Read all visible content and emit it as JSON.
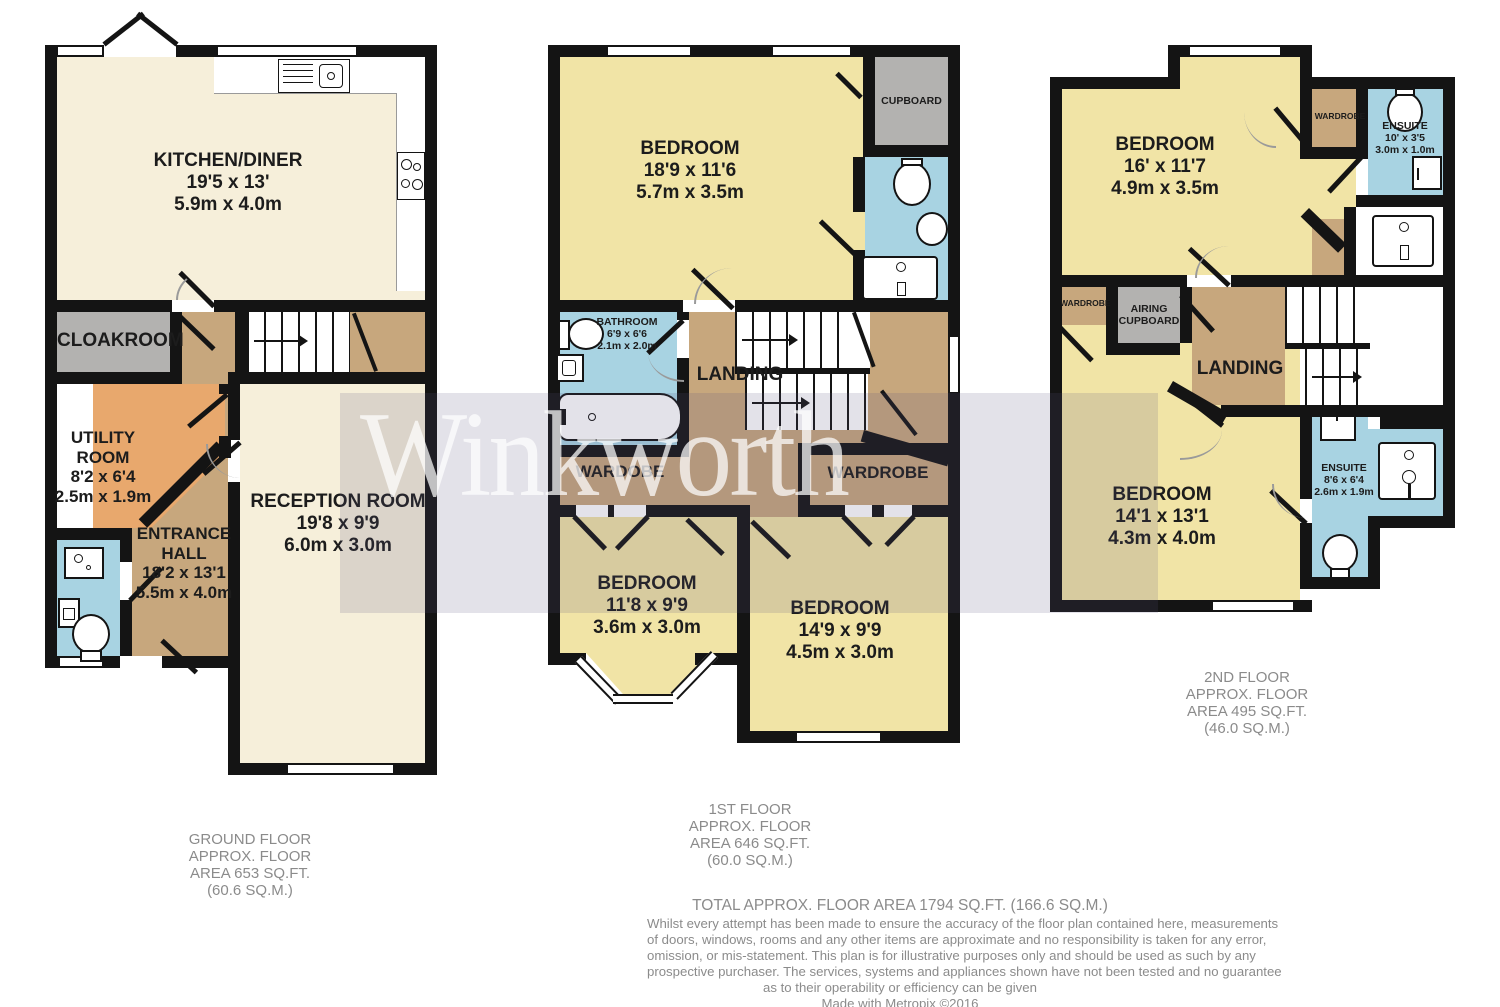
{
  "watermark": {
    "text": "Winkworth"
  },
  "colors": {
    "wall": "#141414",
    "cream": "#F6EFDA",
    "yellow": "#F1E4A6",
    "tan": "#C7A77D",
    "orange": "#E8A86D",
    "blue": "#A8D3E2",
    "grey_room": "#B3B2B0",
    "label_grey": "#8b8b8b",
    "watermark_overlay": "rgba(88,84,126,0.17)"
  },
  "floors": {
    "ground": {
      "rooms": {
        "kitchen": {
          "name": "KITCHEN/DINER",
          "imperial": "19'5 x 13'",
          "metric": "5.9m x 4.0m"
        },
        "cloakroom": {
          "name": "CLOAKROOM"
        },
        "utility": {
          "lines": [
            "UTILITY",
            "ROOM",
            "8'2 x 6'4",
            "2.5m x 1.9m"
          ]
        },
        "entrance": {
          "lines": [
            "ENTRANCE",
            "HALL",
            "18'2 x 13'1",
            "5.5m x 4.0m"
          ]
        },
        "reception": {
          "name": "RECEPTION ROOM",
          "imperial": "19'8 x 9'9",
          "metric": "6.0m x 3.0m"
        }
      },
      "fixtures": [
        "kitchen-sink",
        "hob",
        "washbasin",
        "appliance",
        "toilet"
      ],
      "label": [
        "GROUND FLOOR",
        "APPROX. FLOOR",
        "AREA 653 SQ.FT.",
        "(60.6 SQ.M.)"
      ]
    },
    "first": {
      "rooms": {
        "bedroom1": {
          "name": "BEDROOM",
          "imperial": "18'9 x 11'6",
          "metric": "5.7m x 3.5m"
        },
        "cupboard": {
          "name": "CUPBOARD"
        },
        "bathroom": {
          "name": "BATHROOM",
          "imperial": "6'9 x 6'6",
          "metric": "2.1m x 2.0m"
        },
        "landing": {
          "name": "LANDING"
        },
        "wardrobe_left": {
          "name": "WARDOBE"
        },
        "wardrobe_right": {
          "name": "WARDROBE"
        },
        "bedroom2": {
          "name": "BEDROOM",
          "imperial": "11'8 x 9'9",
          "metric": "3.6m x 3.0m"
        },
        "bedroom3": {
          "name": "BEDROOM",
          "imperial": "14'9 x 9'9",
          "metric": "4.5m x 3.0m"
        }
      },
      "fixtures": [
        "toilet",
        "washbasin",
        "vanity-sink",
        "bath",
        "toilet",
        "washbasin"
      ],
      "label": [
        "1ST FLOOR",
        "APPROX. FLOOR",
        "AREA 646 SQ.FT.",
        "(60.0 SQ.M.)"
      ]
    },
    "second": {
      "rooms": {
        "bedroom1": {
          "name": "BEDROOM",
          "imperial": "16' x 11'7",
          "metric": "4.9m x 3.5m"
        },
        "wardrobe_top": {
          "name": "WARDROBE"
        },
        "ensuite_top": {
          "name": "ENSUITE",
          "imperial": "10' x 3'5",
          "metric": "3.0m x 1.0m"
        },
        "wardrobe_left": {
          "name": "WARDROBE"
        },
        "airing": {
          "lines": [
            "AIRING",
            "CUPBOARD"
          ]
        },
        "landing": {
          "name": "LANDING"
        },
        "bedroom2": {
          "name": "BEDROOM",
          "imperial": "14'1 x 13'1",
          "metric": "4.3m x 4.0m"
        },
        "ensuite_bottom": {
          "name": "ENSUITE",
          "imperial": "8'6 x 6'4",
          "metric": "2.6m x 1.9m"
        }
      },
      "fixtures": [
        "toilet",
        "shower",
        "vanity-sink",
        "washbasin",
        "vanity-sink",
        "toilet"
      ],
      "label": [
        "2ND FLOOR",
        "APPROX. FLOOR",
        "AREA 495 SQ.FT.",
        "(46.0 SQ.M.)"
      ]
    }
  },
  "footer": {
    "total": "TOTAL APPROX. FLOOR AREA 1794 SQ.FT. (166.6 SQ.M.)",
    "disclaimer": [
      "Whilst every attempt has been made to ensure the accuracy of the floor plan contained here, measurements",
      "of doors, windows, rooms and any other items are approximate and no responsibility is taken for any error,",
      "omission, or mis-statement. This plan is for illustrative purposes only and should be used as such by any",
      "prospective purchaser. The services, systems and appliances shown have not been tested and no guarantee",
      "as to their operability or efficiency can be given"
    ],
    "credit": "Made with Metropix ©2016"
  }
}
